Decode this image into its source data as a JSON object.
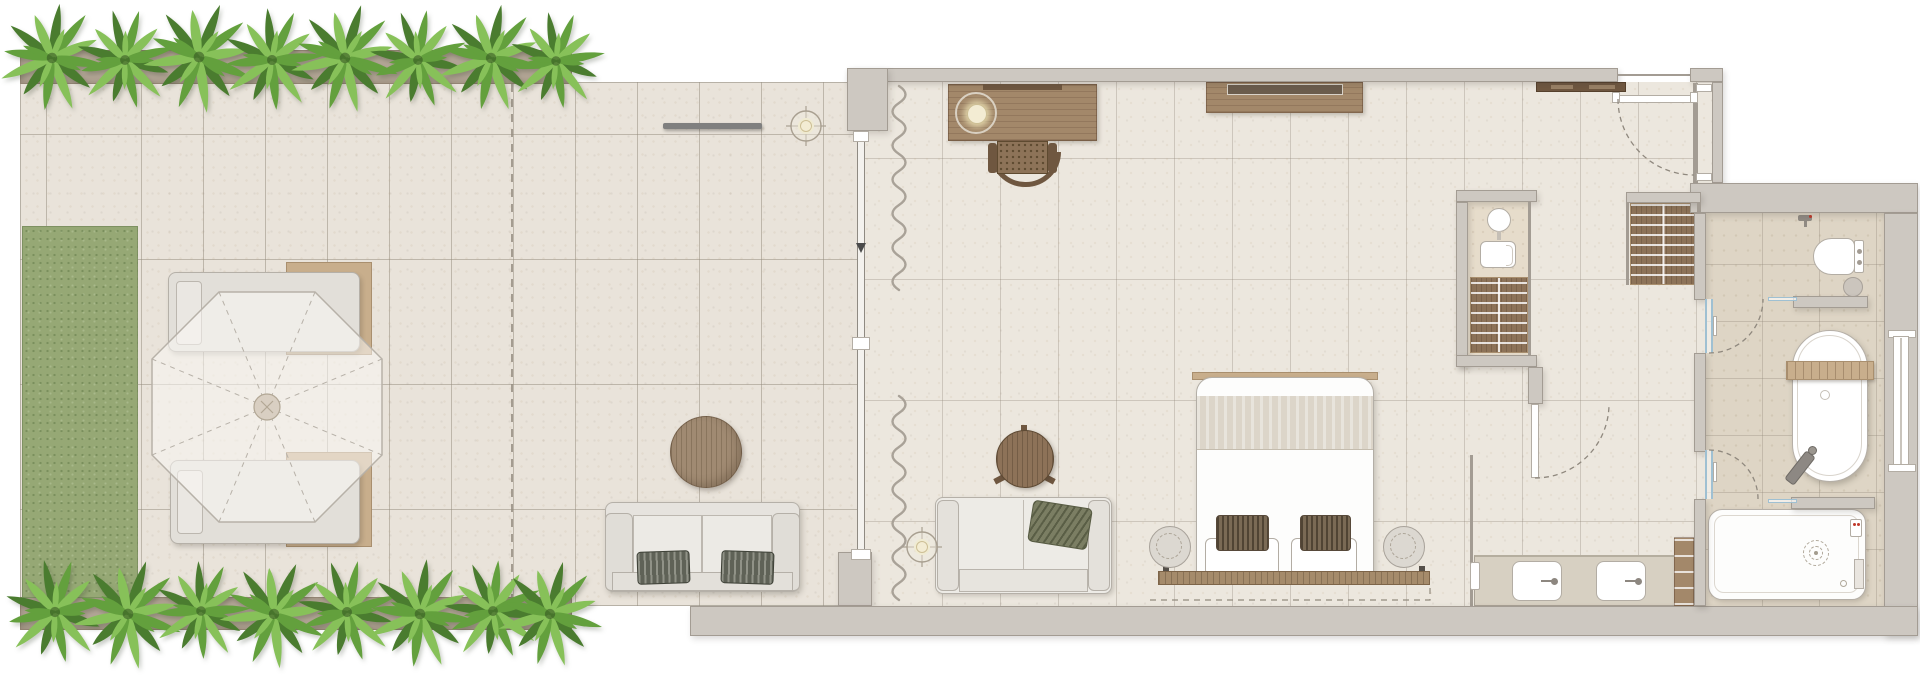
{
  "app": {
    "title": "Resort suite floor plan with terrace"
  },
  "canvas": {
    "width": 1920,
    "height": 675
  },
  "palette": {
    "bg": "#ffffff",
    "terraceTile": "#e9e3da",
    "interiorTile": "#ece7de",
    "bathTile": "#ded5c5",
    "wcTile": "#e6dccb",
    "grass": "#96a875",
    "planter": "#b3a696",
    "tileLine": "rgba(146,137,122,0.5)",
    "tileLineSoft": "rgba(146,137,122,0.35)",
    "wall": "#cdc8c1",
    "wallEdge": "#a39c93",
    "woodLight": "#a3886a",
    "woodMid": "#8d7358",
    "woodDark": "#6f5740",
    "tan": "#c8ae8c",
    "tanDark": "#a98f6e",
    "fixtureStroke": "#b3ada4",
    "glassBlue": "#9fc0d2",
    "plantDark": "#4a7c2f",
    "plantMid": "#63a03d",
    "plantLight": "#87c159",
    "pillowDark": "#6d604d",
    "olive": "#7b7e63",
    "lampGlow": "#f3ecd3",
    "grayBar": "#7f7f7f",
    "dash": "#938b7f"
  },
  "labels": {
    "terrace": "Outdoor terrace",
    "grass": "Lawn strip",
    "planter_top": "Planter with shrubs (top)",
    "planter_bottom": "Planter with shrubs (bottom)",
    "lounger": "Sun lounger",
    "umbrella": "Parasol",
    "outdoor_sofa": "Outdoor sofa",
    "outdoor_table": "Round outdoor coffee table",
    "towel_bar": "Wall-mounted bar",
    "ceiling_light": "Ceiling light",
    "property_line": "Terrace boundary (dashed)",
    "sliding_door": "Sliding glass door",
    "curtain": "Curtain",
    "desk": "Writing desk",
    "desk_lamp": "Desk lamp on tray",
    "desk_chair": "Desk chair",
    "tv_console": "TV console",
    "living_sofa": "Indoor sofa",
    "floor_lamp": "Floor lamp",
    "side_table": "Round side table",
    "bed": "King bed",
    "bed_pillow": "Pillow",
    "bed_bench": "Bed-end bench",
    "pouf": "Round pouf",
    "entry_door": "Entrance door",
    "entry_shelf": "Entry shelf",
    "closet": "Entry closet",
    "wc_room": "Guest WC",
    "wc_basin": "Round basin",
    "wc_toilet": "Toilet",
    "linen_shelves": "Linen shelves",
    "wardrobe": "Wardrobe shelves",
    "corridor_door": "Dressing corridor door",
    "vanity": "Double vanity",
    "sink": "Vanity sink",
    "towel_fixture": "Towel holder",
    "vanity_cabinet": "Towel cabinet",
    "bathroom": "Bathroom",
    "bath_faucet": "Wall faucet",
    "bidet": "Wall-hung toilet",
    "stool": "Bath stool",
    "bathtub": "Freestanding bathtub",
    "tub_caddy": "Wooden tub caddy",
    "tub_faucet": "Floor-standing tub filler",
    "shower": "Walk-in shower",
    "rain_shower": "Rain shower head (dashed)",
    "window": "Bathroom window",
    "glass_door": "Glass door"
  },
  "counts": {
    "plants_top": 8,
    "plants_bottom": 8,
    "loungers": 2,
    "sinks": 2,
    "bed_pillows": 2
  }
}
